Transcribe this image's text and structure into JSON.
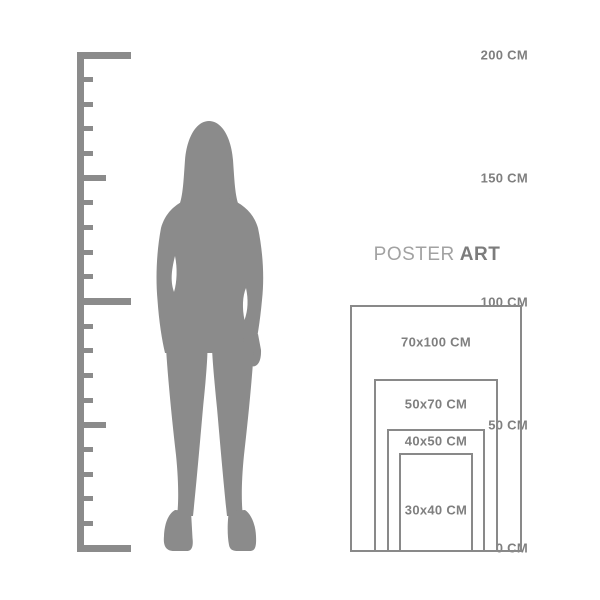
{
  "colors": {
    "shape": "#8b8b8b",
    "text": "#7f7f7f",
    "brand_light": "#a2a2a2",
    "brand_dark": "#7c7c7c",
    "border": "#898989",
    "background": "#ffffff"
  },
  "ruler": {
    "unit": "CM",
    "min_cm": 0,
    "max_cm": 200,
    "tick_step_cm": 10,
    "labels": [
      {
        "text": "200 CM",
        "cm": 200
      },
      {
        "text": "150 CM",
        "cm": 150
      },
      {
        "text": "100 CM",
        "cm": 100
      },
      {
        "text": "50 CM",
        "cm": 50
      },
      {
        "text": "0 CM",
        "cm": 0
      }
    ]
  },
  "figure": {
    "description": "standing-woman-silhouette"
  },
  "brand": {
    "poster": "POSTER",
    "art": "ART"
  },
  "poster_sizes": [
    {
      "label": "70x100 CM",
      "width_cm": 70,
      "height_cm": 100
    },
    {
      "label": "50x70 CM",
      "width_cm": 50,
      "height_cm": 70
    },
    {
      "label": "40x50 CM",
      "width_cm": 40,
      "height_cm": 50
    },
    {
      "label": "30x40 CM",
      "width_cm": 30,
      "height_cm": 40
    }
  ]
}
